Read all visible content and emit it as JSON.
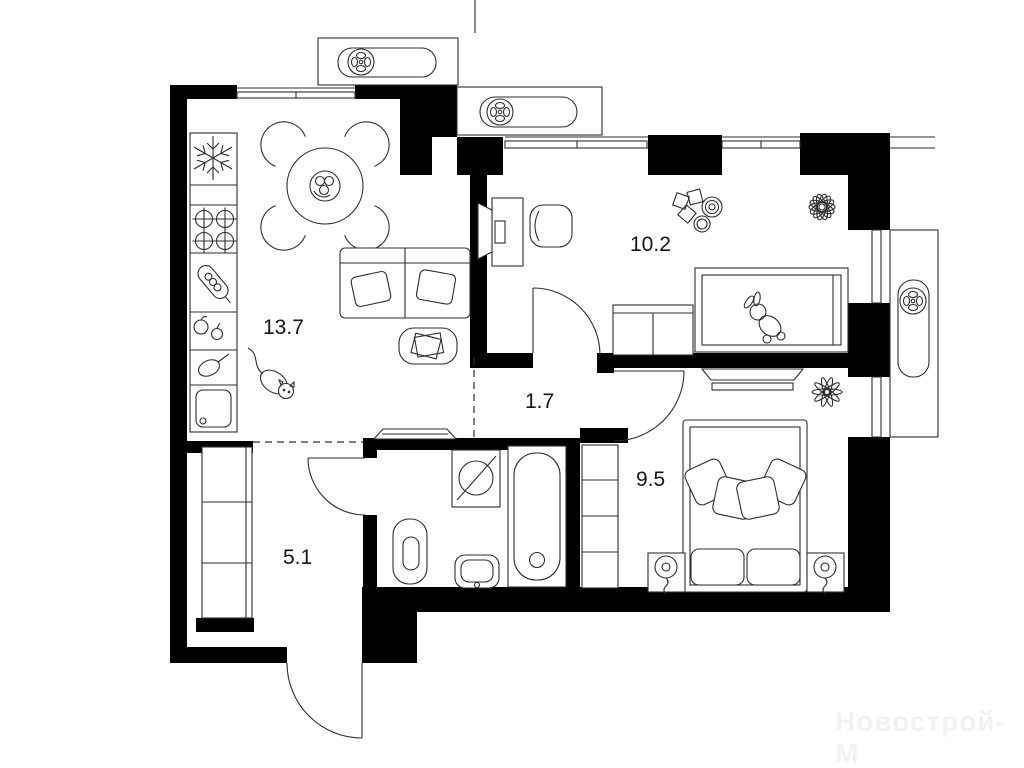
{
  "plan": {
    "type": "apartment-floor-plan",
    "units": "m2",
    "rooms": [
      {
        "id": "kitchen-living-room",
        "label": "13.7"
      },
      {
        "id": "child-bedroom",
        "label": "10.2"
      },
      {
        "id": "hallway",
        "label": "1.7"
      },
      {
        "id": "bedroom",
        "label": "9.5"
      },
      {
        "id": "entrance-hall",
        "label": "5.1"
      }
    ]
  },
  "watermark": {
    "text": "Новострой-М",
    "color": "#f1f1f1"
  },
  "colors": {
    "wall": "#000000",
    "line": "#2e2e2e",
    "background": "#ffffff",
    "label": "#151515"
  },
  "icons": [
    "fan-icon",
    "snowflake-icon",
    "burner-icon",
    "washing-machine-icon",
    "bathtub-icon",
    "toilet-icon",
    "sink-icon",
    "bed-icon",
    "sofa-icon",
    "dining-table-icon",
    "plant-icon",
    "cat-icon",
    "toy-bunny-icon",
    "lamp-icon"
  ]
}
